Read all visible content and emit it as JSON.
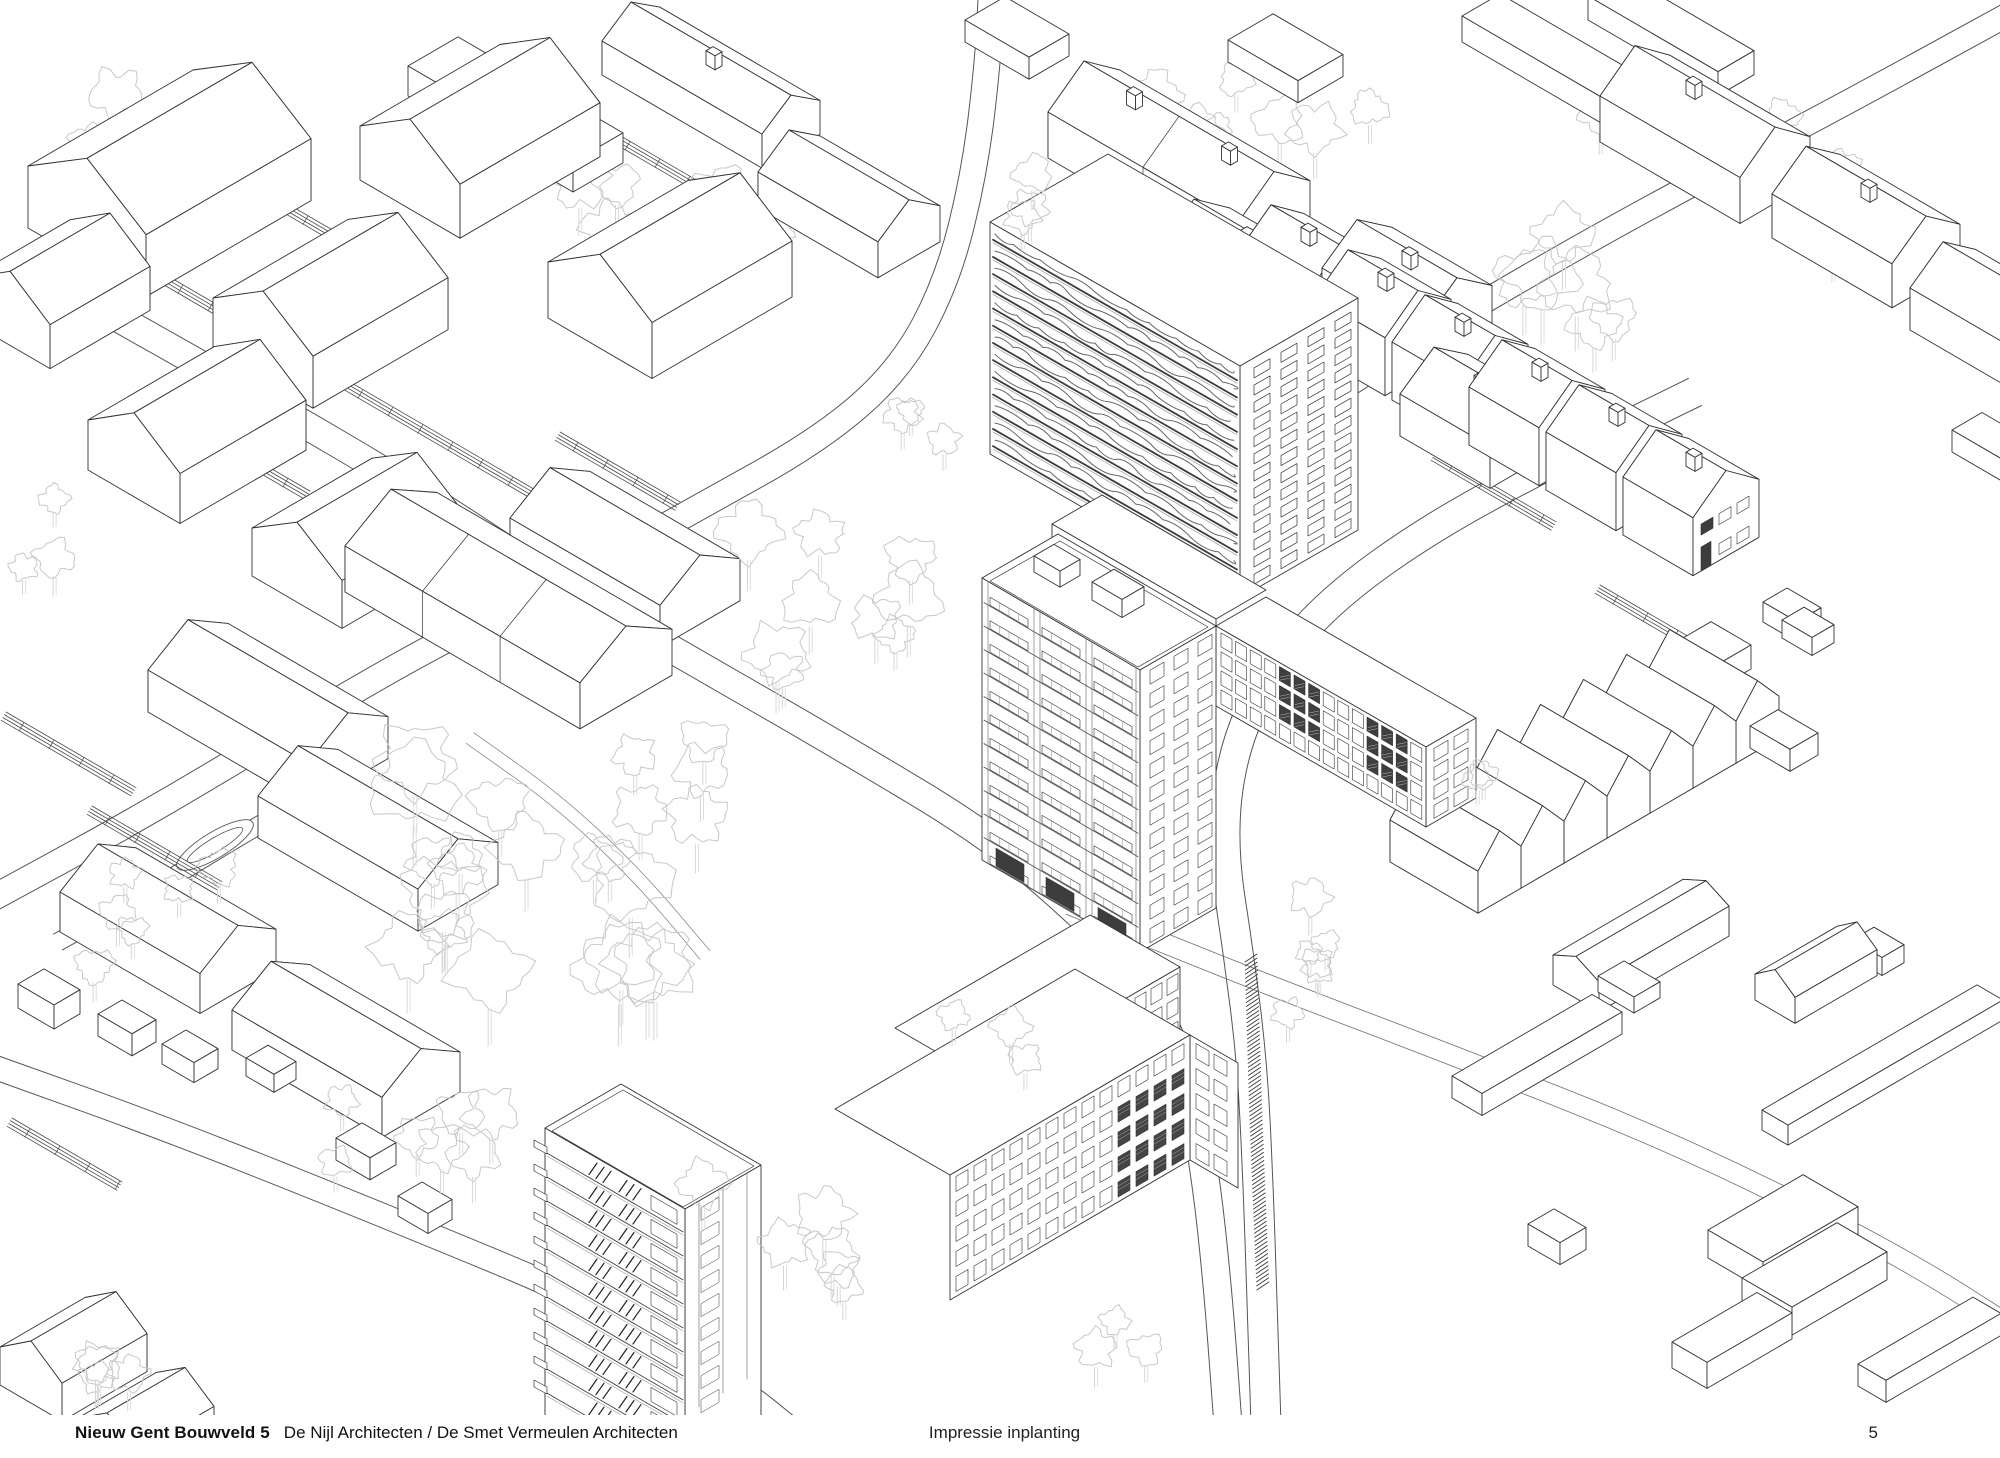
{
  "page": {
    "background": "#ffffff",
    "ink": "#333333",
    "tree_ink": "#c8c8c8",
    "road_ink": "#555555"
  },
  "footer": {
    "project_title": "Nieuw Gent Bouwveld 5",
    "architects": "De Nijl Architecten / De Smet Vermeulen Architecten",
    "caption": "Impressie inplanting",
    "page_number": "5"
  }
}
